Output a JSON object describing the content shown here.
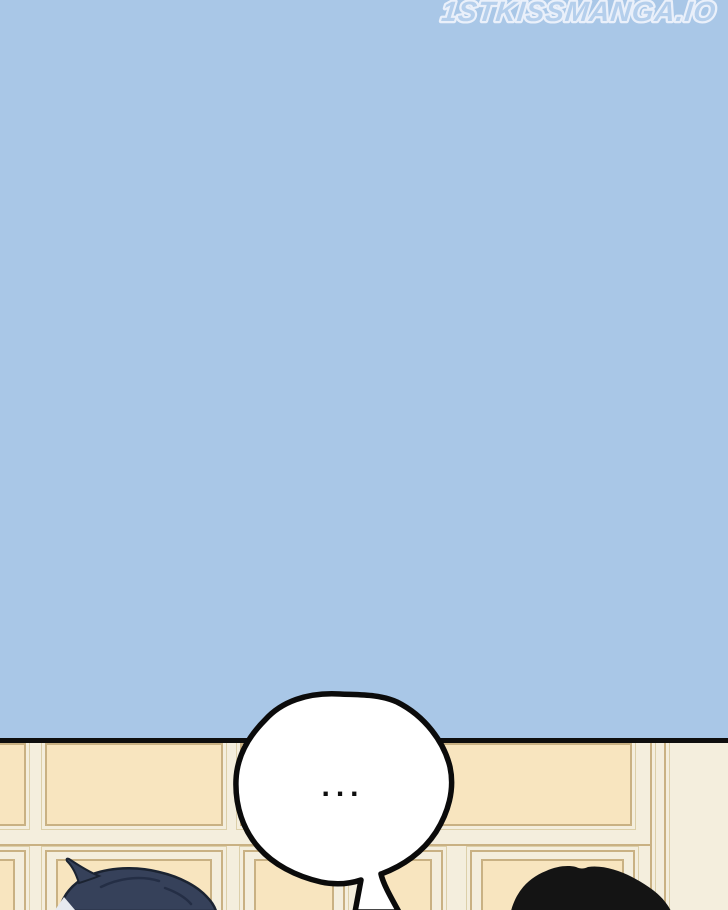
{
  "page": {
    "watermark": "1STKISSMANGA.IO",
    "speech_bubble": {
      "text": "..."
    }
  },
  "scene": {
    "description_elements": {
      "sky_panel": "empty light blue panel",
      "wall": "cream wainscot paneled wall",
      "left_character": "navy-blue haired head, back view",
      "right_character": "black haired head, back view"
    }
  },
  "colors": {
    "sky": "#a9c7e7",
    "ink": "#0e0e0e",
    "wall-base": "#f4eedd",
    "wall-panel": "#f8e5bf",
    "wall-line": "#c9b183",
    "wall-line-light": "#dccfa9",
    "bubble-fill": "#ffffff",
    "bubble-outline": "#0b0b0b",
    "hair-left": "#36415a",
    "hair-left-dark": "#242e45",
    "hair-left-outline": "#1b2331",
    "hair-left-skin": "#e7eaef",
    "hair-right": "#141414",
    "watermark-fill": "#b5cfec",
    "watermark-outline": "#eaf0fa"
  }
}
